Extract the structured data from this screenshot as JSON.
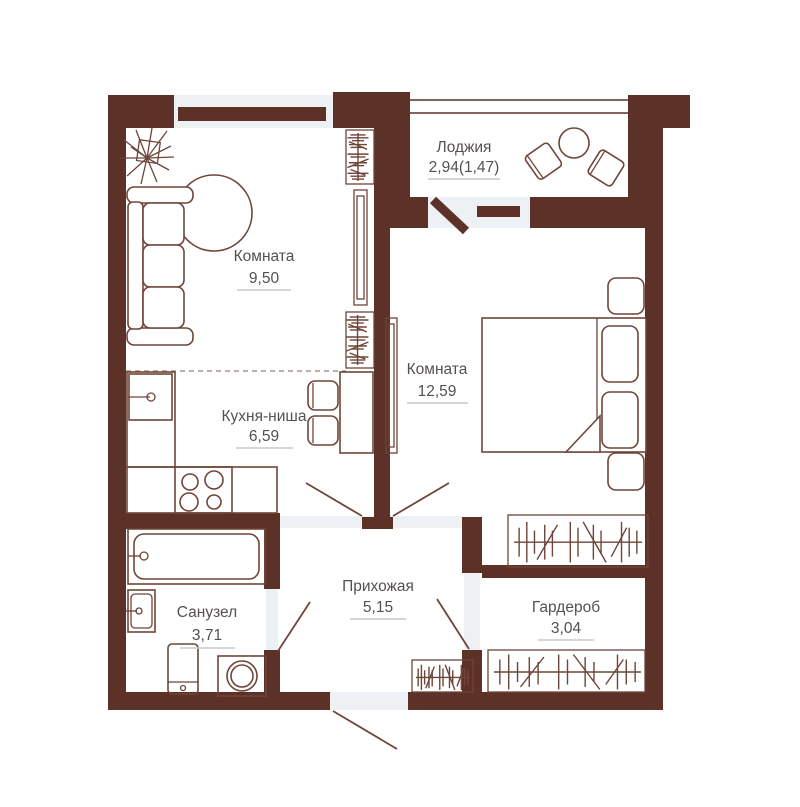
{
  "plan": {
    "type": "apartment-floor-plan",
    "rooms": [
      {
        "name": "Комната",
        "area": "9,50"
      },
      {
        "name": "Кухня-ниша",
        "area": "6,59"
      },
      {
        "name": "Комната",
        "area": "12,59"
      },
      {
        "name": "Лоджия",
        "area": "2,94(1,47)"
      },
      {
        "name": "Прихожая",
        "area": "5,15"
      },
      {
        "name": "Санузел",
        "area": "3,71"
      },
      {
        "name": "Гардероб",
        "area": "3,04"
      }
    ],
    "colors": {
      "wall": "#5c3128",
      "furniture": "#6e4539",
      "text": "#55514d",
      "underline": "#c8c8c8",
      "window": "#eef1f3",
      "background": "#ffffff"
    }
  }
}
